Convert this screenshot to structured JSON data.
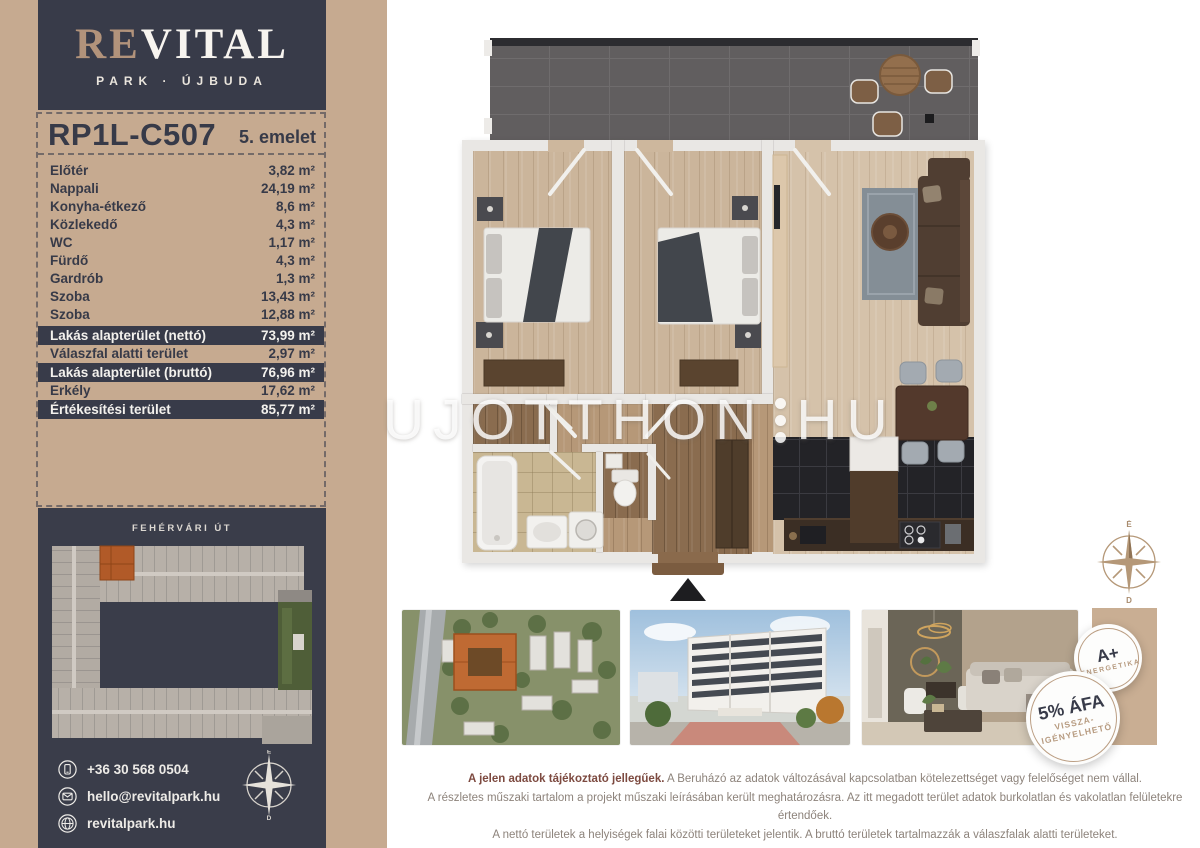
{
  "brand": {
    "name_part1": "RE",
    "name_part2": "VITAL",
    "subtitle": "PARK · ÚJBUDA"
  },
  "unit": {
    "code": "RP1L-C507",
    "floor": "5. emelet"
  },
  "rooms": [
    {
      "name": "Előtér",
      "area": "3,82 m²"
    },
    {
      "name": "Nappali",
      "area": "24,19 m²"
    },
    {
      "name": "Konyha-étkező",
      "area": "8,6 m²"
    },
    {
      "name": "Közlekedő",
      "area": "4,3 m²"
    },
    {
      "name": "WC",
      "area": "1,17 m²"
    },
    {
      "name": "Fürdő",
      "area": "4,3 m²"
    },
    {
      "name": "Gardrób",
      "area": "1,3 m²"
    },
    {
      "name": "Szoba",
      "area": "13,43 m²"
    },
    {
      "name": "Szoba",
      "area": "12,88 m²"
    }
  ],
  "summary": [
    {
      "label": "Lakás alapterület (nettó)",
      "value": "73,99 m²",
      "emphasis": true
    },
    {
      "label": "Válaszfal alatti terület",
      "value": "2,97 m²",
      "emphasis": false
    },
    {
      "label": "Lakás alapterület (bruttó)",
      "value": "76,96 m²",
      "emphasis": true
    },
    {
      "label": "Erkély",
      "value": "17,62 m²",
      "emphasis": false
    },
    {
      "label": "Értékesítési terület",
      "value": "85,77 m²",
      "emphasis": true
    }
  ],
  "site_map": {
    "street_top": "FEHÉRVÁRI ÚT",
    "street_right": "BARÁZDA UTCA"
  },
  "contacts": [
    {
      "icon": "phone-icon",
      "text": "+36 30 568 0504"
    },
    {
      "icon": "email-icon",
      "text": "hello@revitalpark.hu"
    },
    {
      "icon": "globe-icon",
      "text": "revitalpark.hu"
    }
  ],
  "compass": {
    "n": "É",
    "e": "K",
    "s": "D",
    "w": "NY"
  },
  "watermark": {
    "text": "UJOTTHON",
    "suffix": "HU"
  },
  "badges": {
    "energy": {
      "grade": "A+",
      "label": "ENERGETIKA"
    },
    "vat": {
      "title": "5% ÁFA",
      "line1": "VISSZA-",
      "line2": "IGÉNYELHETŐ"
    }
  },
  "disclaimer": {
    "intro": "A jelen adatok tájékoztató jellegűek.",
    "line1_rest": " A Beruházó az adatok változásával kapcsolatban kötelezettséget vagy felelőséget nem vállal.",
    "line2": "A részletes műszaki tartalom a projekt műszaki leírásában került meghatározásra. Az itt megadott terület adatok burkolatlan és vakolatlan felületekre értendőek.",
    "line3": "A nettó területek a helyiségek falai közötti területeket jelentik. A bruttó területek tartalmazzák a válaszfalak alatti területeket."
  },
  "colors": {
    "tan": "#c6aa90",
    "navy": "#383b49",
    "badge_tan": "#b79b80",
    "highlight_orange": "#b15a28",
    "maroon": "#7d4a40"
  }
}
